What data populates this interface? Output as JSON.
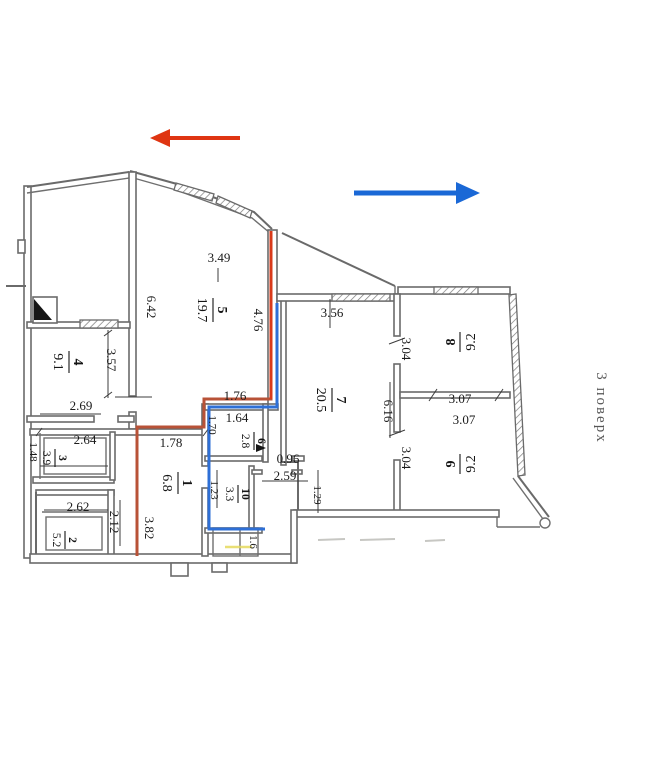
{
  "annotations": {
    "floor_label": "3 поверх",
    "red_arrow": {
      "direction": "left",
      "color": "#df3512"
    },
    "blue_arrow": {
      "direction": "right",
      "color": "#1a68d6"
    },
    "red_line_color": "#b85237",
    "red_line_bright": "#d93a1a",
    "blue_line_color": "#2e6fd6"
  },
  "rooms": [
    {
      "number": "1",
      "area": "6.8"
    },
    {
      "number": "2",
      "area": "5.2"
    },
    {
      "number": "3",
      "area": "3.9"
    },
    {
      "number": "4",
      "area": "9.1"
    },
    {
      "number": "5",
      "area": "19.7"
    },
    {
      "number": "6",
      "area": "2.8"
    },
    {
      "number": "7",
      "area": "20.5"
    },
    {
      "number": "8",
      "area": "9.2"
    },
    {
      "number": "9",
      "area": "9.2"
    },
    {
      "number": "10",
      "area": "3.3"
    }
  ],
  "dims": [
    {
      "v": "3.49"
    },
    {
      "v": "6.42"
    },
    {
      "v": "4.76"
    },
    {
      "v": "3.57"
    },
    {
      "v": "2.69"
    },
    {
      "v": "2.64"
    },
    {
      "v": "1.78"
    },
    {
      "v": "1.48"
    },
    {
      "v": "2.62"
    },
    {
      "v": "2.12"
    },
    {
      "v": "3.82"
    },
    {
      "v": "1.76"
    },
    {
      "v": "1.64"
    },
    {
      "v": "1.70"
    },
    {
      "v": "1.23"
    },
    {
      "v": "0.96"
    },
    {
      "v": "2.59"
    },
    {
      "v": "1.29"
    },
    {
      "v": "1.6"
    },
    {
      "v": "3.56"
    },
    {
      "v": "3.04"
    },
    {
      "v": "6.16"
    },
    {
      "v": "3.04"
    },
    {
      "v": "3.07"
    },
    {
      "v": "3.07"
    }
  ]
}
